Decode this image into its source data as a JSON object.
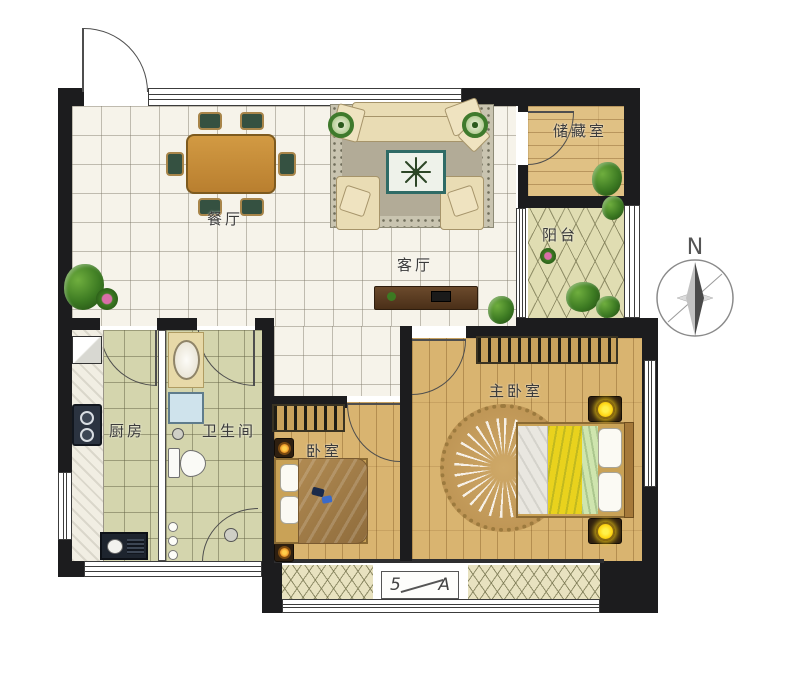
{
  "compass": {
    "label": "N"
  },
  "rooms": {
    "dining": "餐厅",
    "living": "客厅",
    "storage": "储藏室",
    "balcony": "阳台",
    "kitchen": "厨房",
    "bathroom": "卫生间",
    "bedroom": "卧室",
    "master": "主卧室"
  },
  "section_marker": {
    "left": "5",
    "right": "A"
  },
  "colors": {
    "wall": "#1c1c1e",
    "marble_floor": "#f6f3ea",
    "green_tile_floor": "#d4d5ad",
    "wood_floor": "#d9b470",
    "balcony_tile": "#e0ddb2",
    "living_rug": "#b2ab97",
    "bedroom_blanket_brown": "#9e7946",
    "master_blanket_yellow": "#e9d21d",
    "lamp_glow_yellow": "#ffd715",
    "lamp_glow_orange": "#e07c1a"
  }
}
